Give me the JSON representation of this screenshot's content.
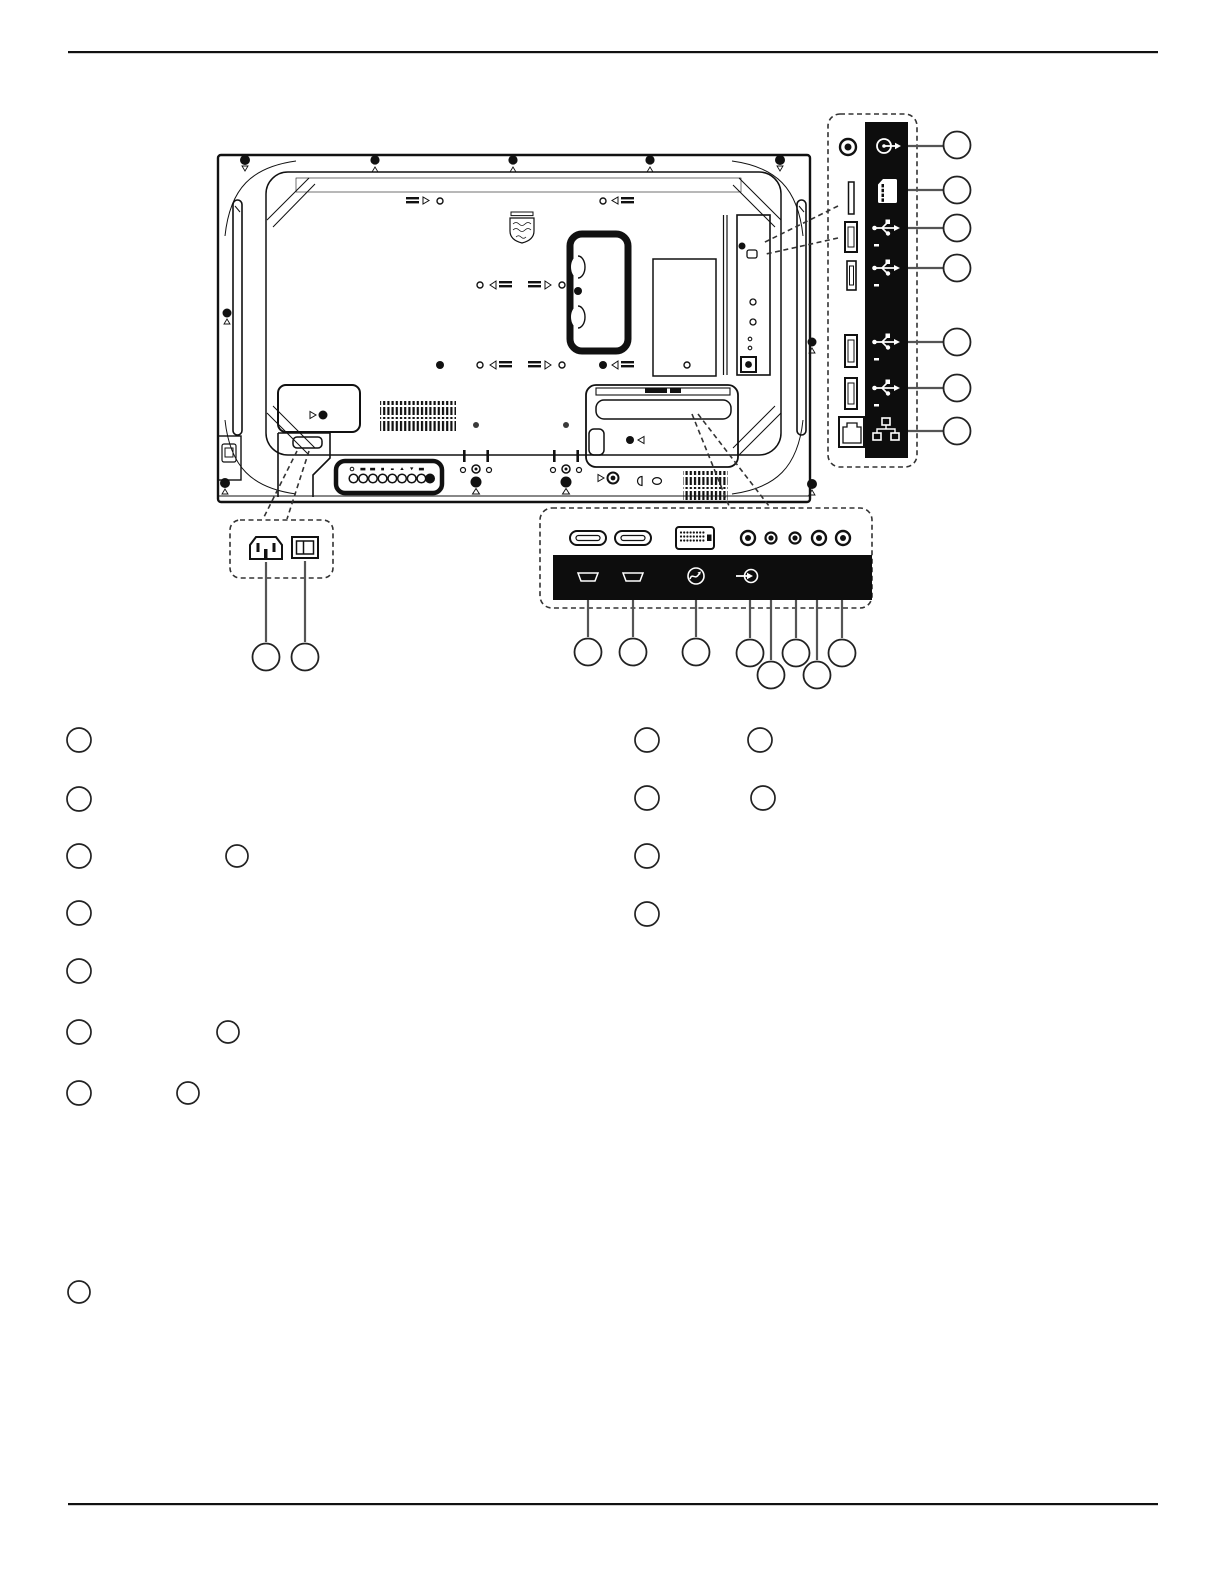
{
  "page": {
    "background": "#ffffff",
    "line_color": "#111111",
    "leader_color": "#555555",
    "dash_color": "#333333",
    "panel_black": "#0d0d0d",
    "visible_text": "",
    "has_top_rule": true,
    "has_bottom_rule": true
  },
  "rear_view": {
    "description": "line-art rear view of a flat-panel display",
    "brand_logo": "philips-shield-logo",
    "features": [
      "mounting-screws",
      "vesa-hole-markers",
      "vent-grilles",
      "carry-handle",
      "rating-label",
      "side-io-recess",
      "bottom-io-recess",
      "ac-inlet-recess",
      "control-button-panel",
      "speaker-slots"
    ]
  },
  "side_io_callout": {
    "ports": [
      {
        "icon": "out-jack-icon",
        "connector": "3.5mm-jack"
      },
      {
        "icon": "microsd-card-icon",
        "connector": "microsd-slot"
      },
      {
        "icon": "usb-icon",
        "connector": "usb-port"
      },
      {
        "icon": "usb-icon",
        "connector": "usb-port"
      },
      {
        "icon": "usb-icon",
        "connector": "usb-port"
      },
      {
        "icon": "usb-icon",
        "connector": "usb-port"
      },
      {
        "icon": "lan-icon",
        "connector": "rj45-port"
      }
    ],
    "callout_circle_labels": [
      "",
      "",
      "",
      "",
      "",
      "",
      ""
    ]
  },
  "bottom_io_callout": {
    "ports": [
      "hdmi-port",
      "hdmi-port",
      "dvi-port",
      "rca-jack",
      "rca-jack",
      "rca-jack",
      "rca-jack",
      "rca-jack"
    ],
    "strip_icons": [
      "hdmi-icon",
      "hdmi-icon",
      "sync-wave-icon",
      "line-in-icon"
    ],
    "callout_circle_labels": [
      "",
      "",
      "",
      "",
      "",
      "",
      "",
      ""
    ]
  },
  "ac_callout": {
    "ports": [
      "ac-inlet",
      "main-power-switch"
    ],
    "callout_circle_labels": [
      "",
      ""
    ]
  },
  "legend": {
    "labels_visible": false,
    "left_rows_bullet_counts": [
      1,
      1,
      2,
      1,
      1,
      2,
      2
    ],
    "right_rows_bullet_counts": [
      2,
      2,
      1,
      1
    ],
    "footnote_bullet_count": 1
  }
}
